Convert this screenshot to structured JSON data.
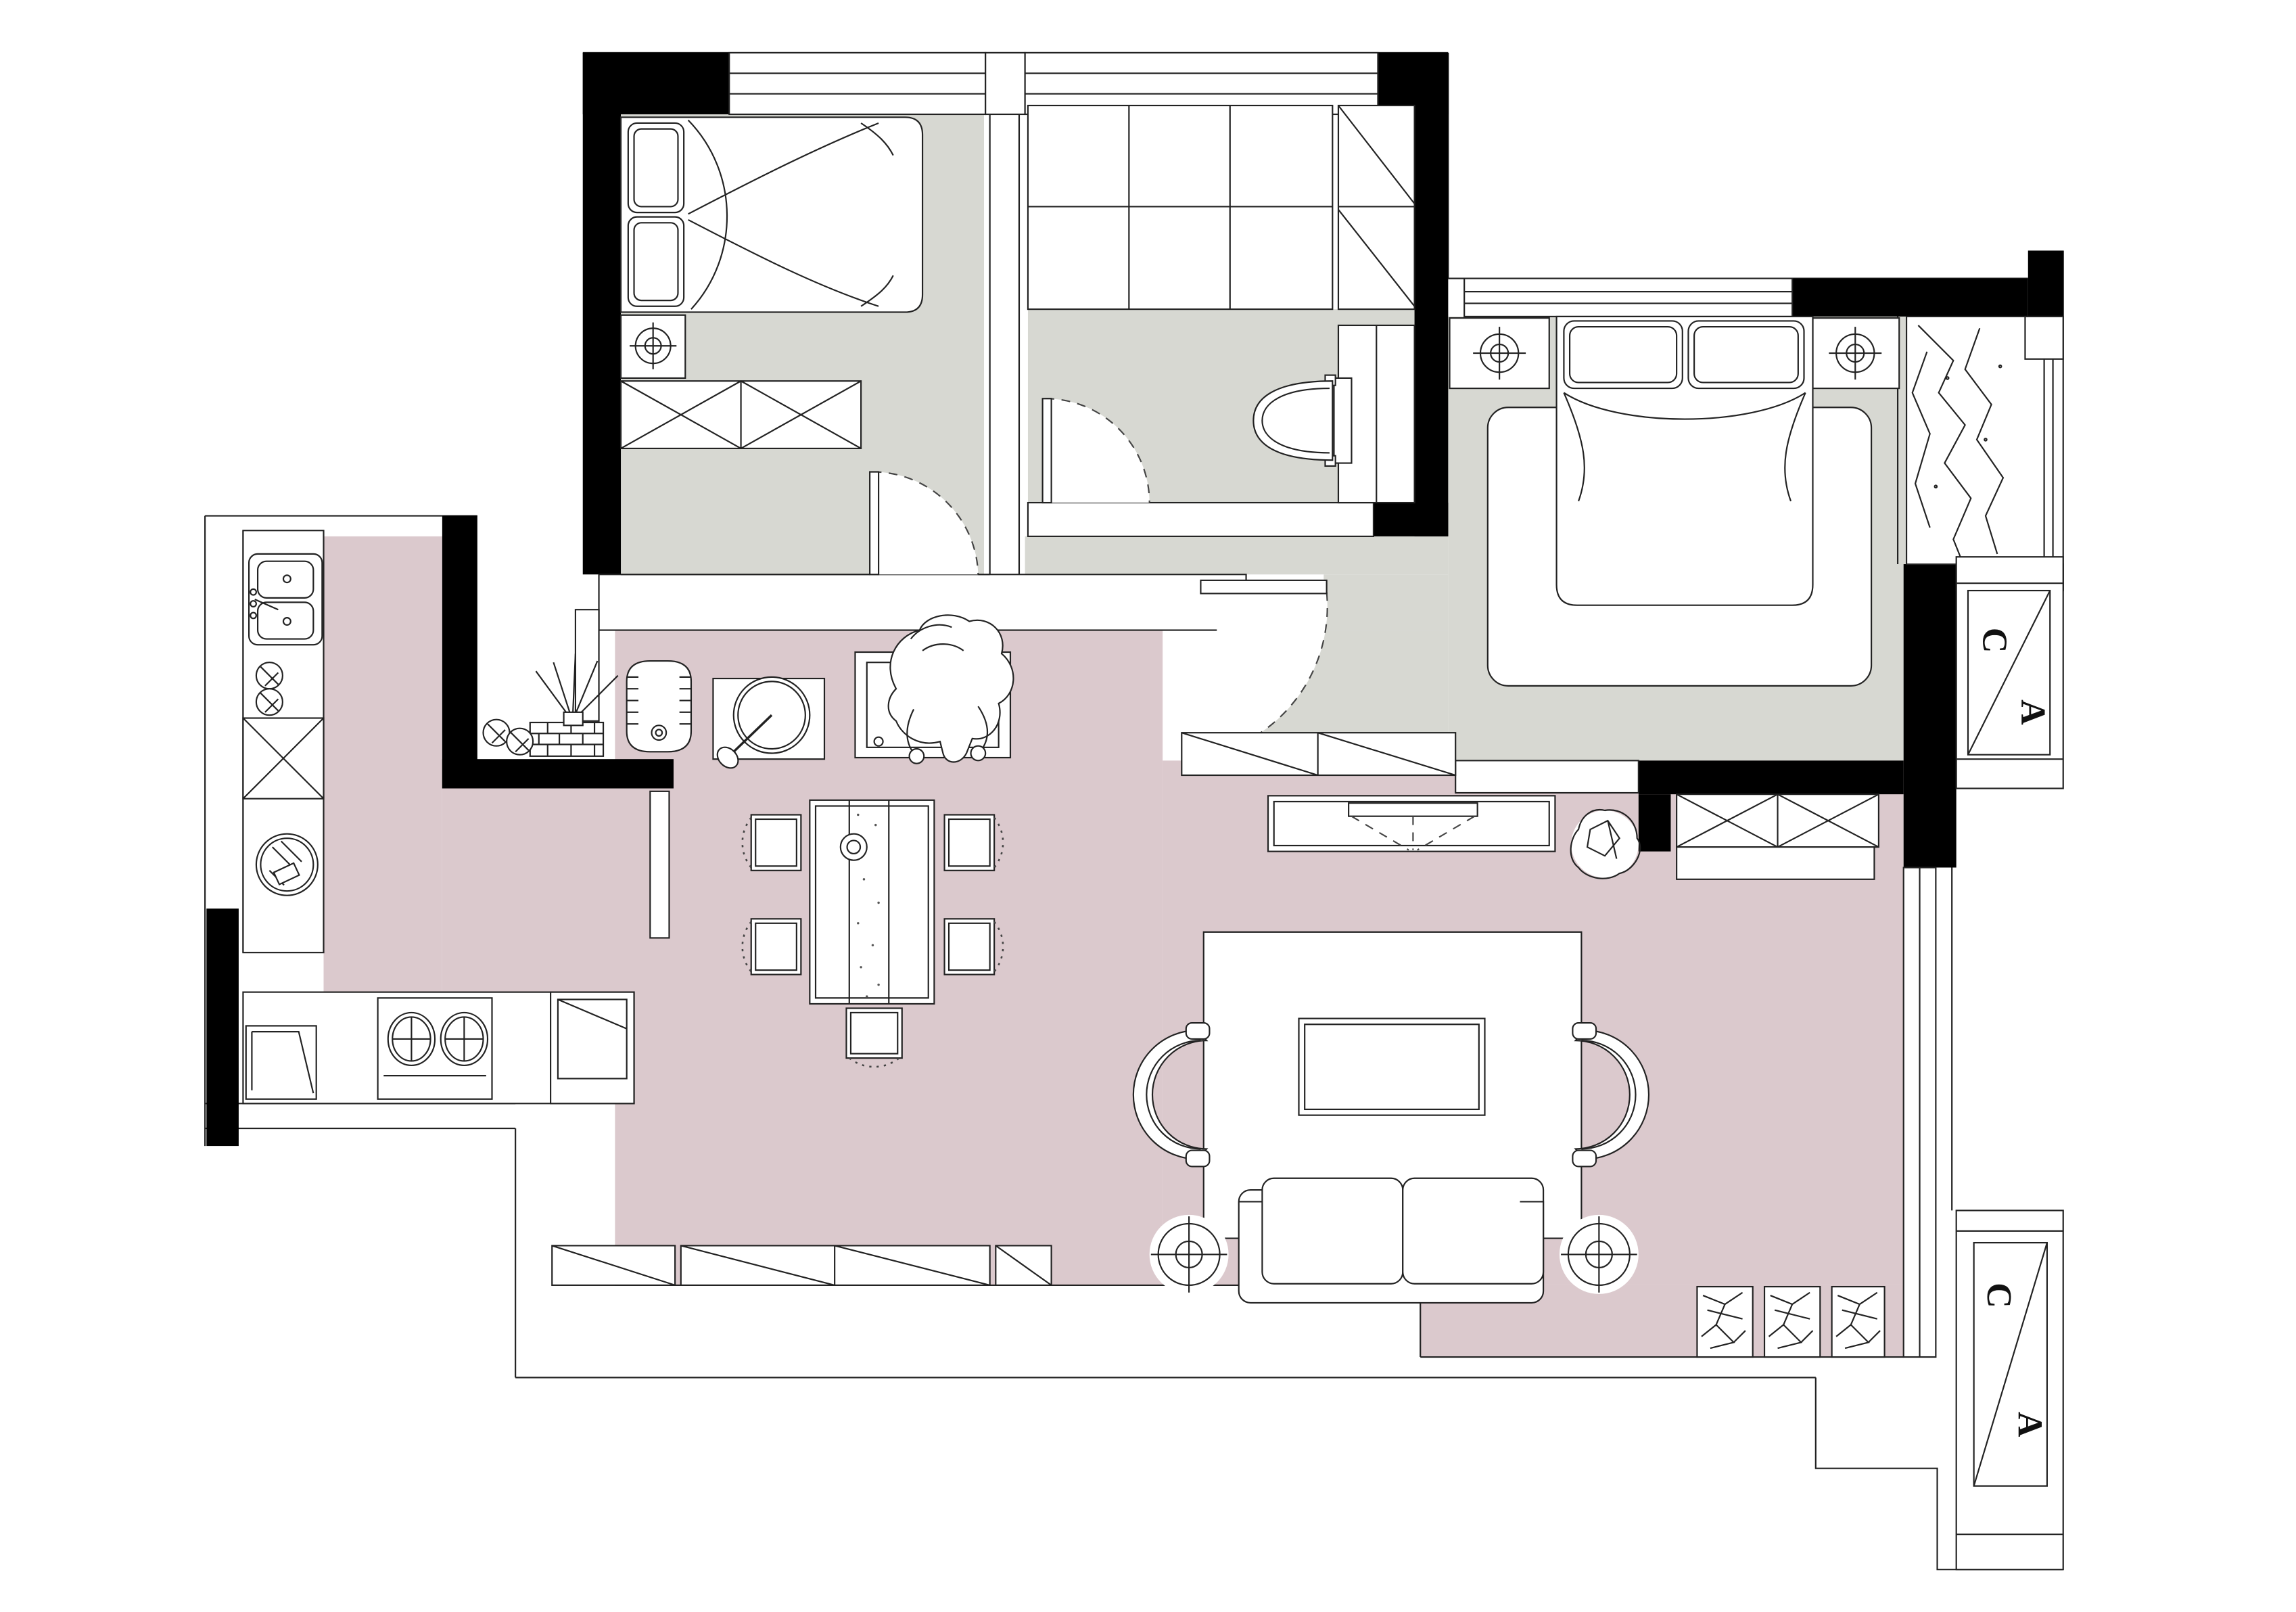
{
  "title": "apartment-floor-plan",
  "palette": {
    "floor_pink": "#dbc9cd",
    "floor_gray": "#d7d8d2",
    "wall": "#000000",
    "background": "#ffffff"
  },
  "markers": {
    "upper_panel": {
      "top": "C",
      "bottom": "A"
    },
    "lower_panel": {
      "top": "C",
      "bottom": "A"
    }
  }
}
